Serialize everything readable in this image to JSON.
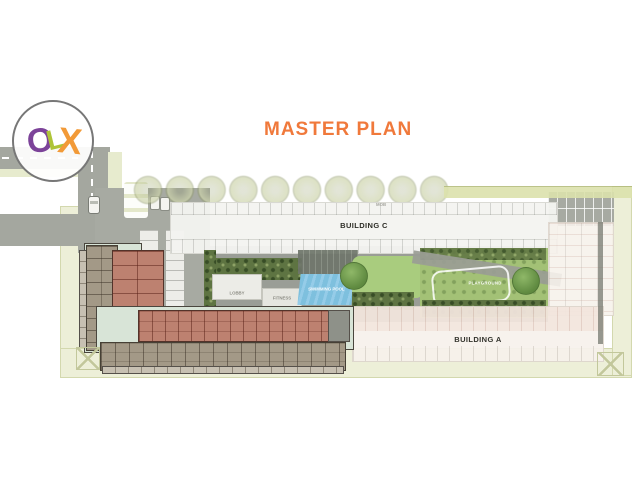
{
  "title": {
    "text": "MASTER PLAN"
  },
  "logo": {
    "o": "O",
    "l": "L",
    "x": "X"
  },
  "plan": {
    "building_c": "BUILDING C",
    "building_a": "BUILDING A",
    "lobby": "LOBBY",
    "fitness": "FITNESS",
    "swimming_pool": "SWIMMING POOL",
    "playground": "PLAYGROUND",
    "mob": "MOB"
  },
  "colors": {
    "accent_orange": "#F0793B",
    "logo_o_purple": "#7C4399",
    "logo_l_green": "#AEC437",
    "logo_x_orange": "#F29A38",
    "road_gray": "#A4A79F",
    "deck_gray": "#9A9D96",
    "site_edge_green": "#EDEFD8",
    "pool_blue": "#7EC0DE",
    "lawn_green": "#A9CC7E",
    "planting_dark_green": "#5E7442",
    "unit_salmon": "#BD8170",
    "unit_brown": "#A39987",
    "corridor_mint": "#D8E4D7",
    "building_white": "#F4F4F1",
    "building_a_pink": "#F3E6DE",
    "label_dark": "#26261F"
  }
}
